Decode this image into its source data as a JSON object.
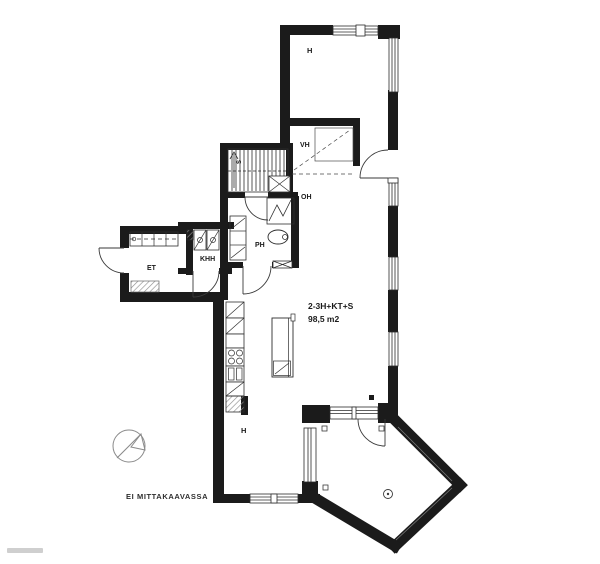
{
  "apartment": {
    "type": "2-3H+KT+S",
    "area": "98,5 m2"
  },
  "rooms": {
    "bedroom_top": {
      "label": "H"
    },
    "closet": {
      "label": "VH"
    },
    "living": {
      "label": "OH"
    },
    "stairs": {
      "label": "S"
    },
    "bathroom": {
      "label": "PH"
    },
    "utility": {
      "label": "KHH"
    },
    "entry": {
      "label": "ET"
    },
    "bedroom_bottom": {
      "label": "H"
    }
  },
  "footer": {
    "scale_note": "EI MITTAKAAVASSA"
  },
  "colors": {
    "wall": "#1b1b1b",
    "line": "#3a3a3a",
    "light": "#8a8a8a",
    "background": "#ffffff"
  }
}
